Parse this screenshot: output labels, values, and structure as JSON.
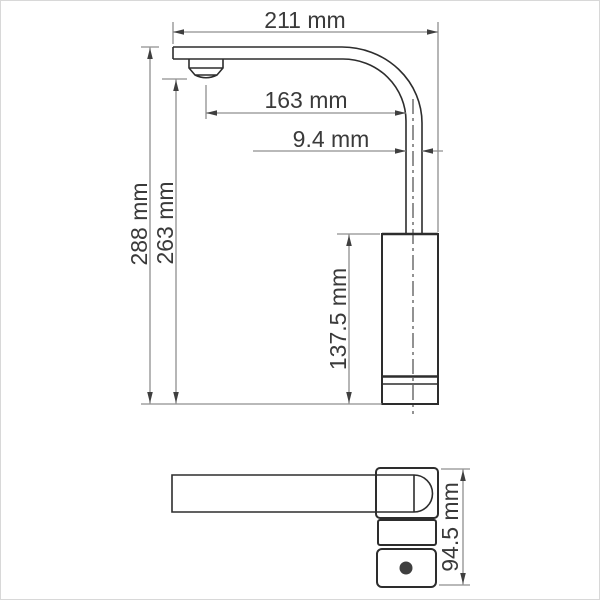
{
  "drawing": {
    "dimensions": {
      "total_width": "211 mm",
      "spout_reach": "163 mm",
      "pipe_width": "9.4 mm",
      "total_height": "288 mm",
      "outlet_height": "263 mm",
      "body_height": "137.5 mm",
      "base_depth": "94.5 mm"
    },
    "colors": {
      "object_line": "#2d2d2d",
      "dimension_line": "#8f8f8f",
      "arrowhead": "#3f3f3f",
      "text": "#3a3a3a",
      "background": "#ffffff",
      "border": "#d8d8d8"
    }
  }
}
